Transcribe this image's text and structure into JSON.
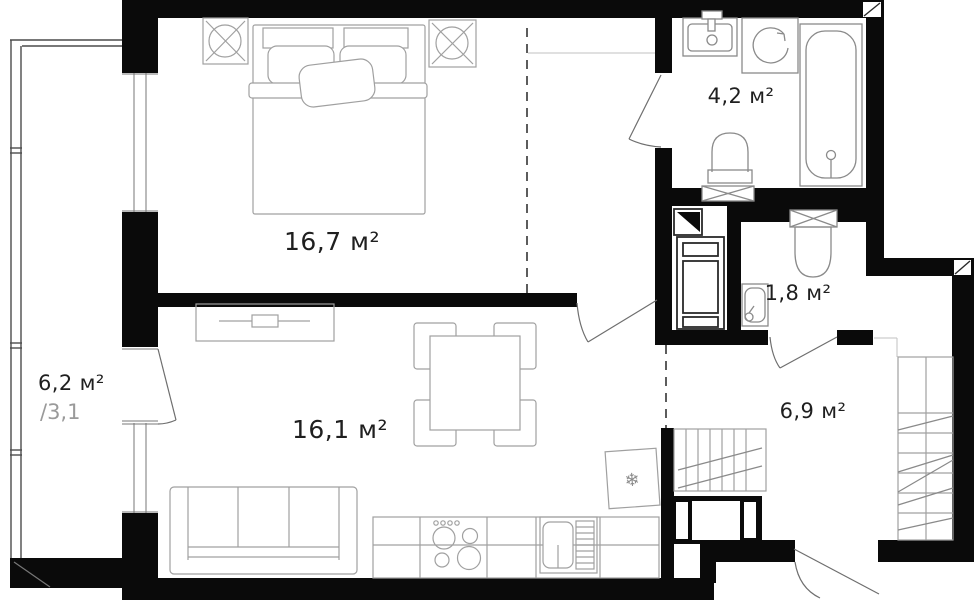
{
  "plan": {
    "rooms": {
      "bedroom": {
        "area_label": "16,7 м²"
      },
      "living_kitchen": {
        "area_label": "16,1 м²"
      },
      "balcony": {
        "area_label": "6,2 м²",
        "secondary_label": "/3,1"
      },
      "bathroom": {
        "area_label": "4,2 м²"
      },
      "wc": {
        "area_label": "1,8 м²"
      },
      "hallway": {
        "area_label": "6,9 м²"
      }
    },
    "icons": {
      "fridge_snowflake": "❄"
    },
    "colors": {
      "wall": "#0a0a0a",
      "background": "#ffffff",
      "furniture_line": "#a0a0a0",
      "fixture_line": "#8a8a8a",
      "label": "#1f1f1f",
      "secondary_label": "#9a9a9a"
    }
  }
}
